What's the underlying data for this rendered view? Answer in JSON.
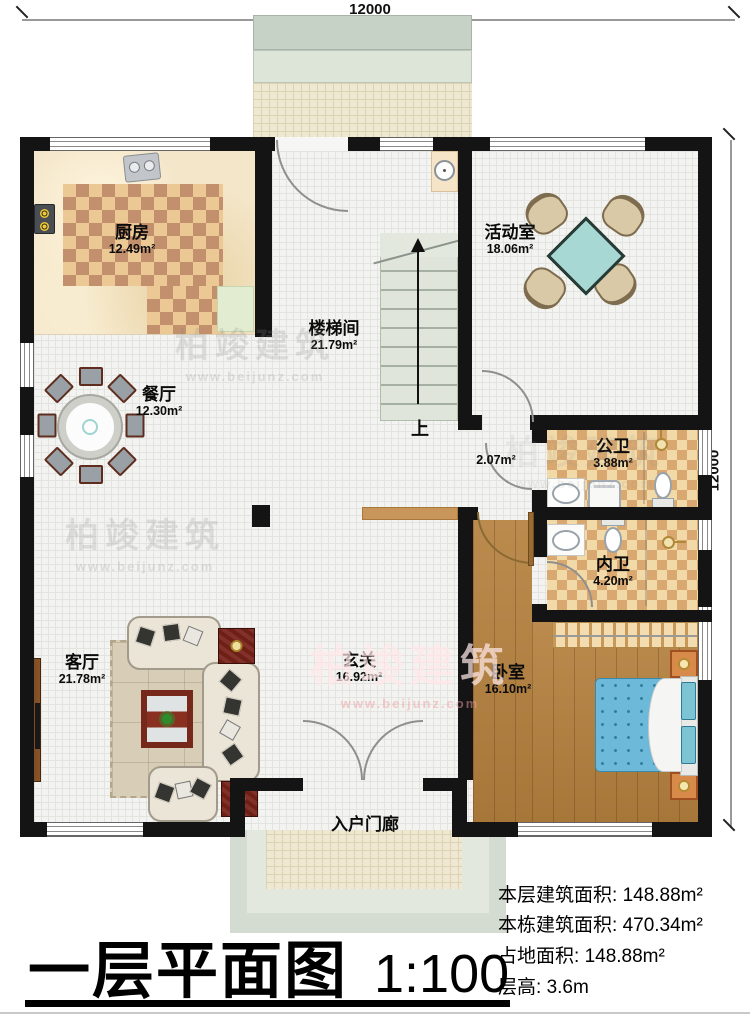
{
  "dimensions": {
    "top": "12000",
    "right": "12000"
  },
  "rooms": {
    "kitchen": {
      "name": "厨房",
      "area": "12.49m²"
    },
    "activity": {
      "name": "活动室",
      "area": "18.06m²"
    },
    "stairwell": {
      "name": "楼梯间",
      "area": "21.79m²"
    },
    "dining": {
      "name": "餐厅",
      "area": "12.30m²"
    },
    "public_bath": {
      "name": "公卫",
      "area": "3.88m²"
    },
    "private_bath": {
      "name": "内卫",
      "area": "4.20m²"
    },
    "living": {
      "name": "客厅",
      "area": "21.78m²"
    },
    "foyer": {
      "name": "玄关",
      "area": "16.92m²"
    },
    "bedroom": {
      "name": "卧室",
      "area": "16.10m²"
    },
    "porch": {
      "name": "入户门廊"
    },
    "corridor": {
      "area": "2.07m²"
    },
    "stairs_up": "上"
  },
  "title": {
    "text": "一层平面图",
    "scale": "1:100"
  },
  "stats": [
    {
      "label": "本层建筑面积:",
      "value": "148.88m²"
    },
    {
      "label": "本栋建筑面积:",
      "value": "470.34m²"
    },
    {
      "label": "占地面积:",
      "value": "148.88m²"
    },
    {
      "label": "层高:",
      "value": "3.6m"
    }
  ],
  "watermark": {
    "name": "柏竣建筑",
    "url": "www.beijunz.com"
  }
}
